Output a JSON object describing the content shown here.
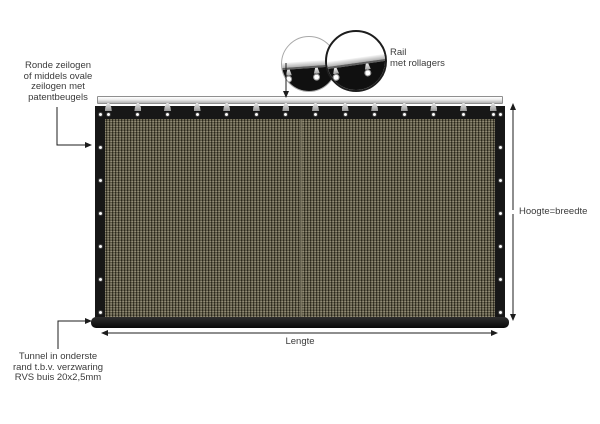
{
  "canvas": {
    "width": 600,
    "height": 424,
    "background": "#ffffff"
  },
  "labels": {
    "eyelets": {
      "lines": [
        "Ronde zeilogen",
        "of middels ovale",
        "zeilogen met",
        "patentbeugels"
      ]
    },
    "rail": {
      "lines": [
        "Rail",
        "met rollagers"
      ]
    },
    "height_dimension": "Hoogte=breedte",
    "length_dimension": "Lengte",
    "tunnel": {
      "lines": [
        "Tunnel in onderste",
        "rand t.b.v. verzwaring",
        "RVS buis 20x2,5mm"
      ]
    }
  },
  "colors": {
    "fabric_base": "#8c8670",
    "fabric_weave_dark": "#3f3c2b",
    "fabric_weave_light": "#9e9880",
    "panel_border": "#171717",
    "rail_light": "#ececec",
    "rail_shadow": "#b2b2b2",
    "line_and_arrow": "#1c1c1c",
    "text": "#3b3b3b"
  },
  "counts": {
    "top_hangers": 14,
    "top_eyelets": 14,
    "side_eyelets_per_edge": 7
  }
}
